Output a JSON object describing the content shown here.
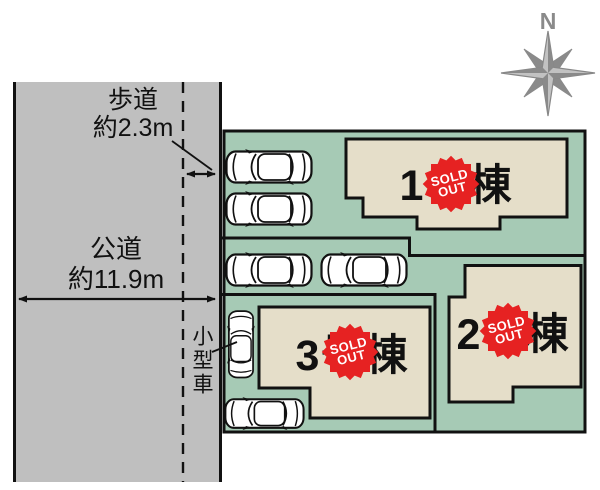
{
  "diagram": {
    "north_label": "N",
    "sidewalk_label": {
      "line1": "歩道",
      "line2": "約2.3m"
    },
    "road_label": {
      "line1": "公道",
      "line2": "約11.9m"
    },
    "small_car_label": "小型車",
    "buildings": [
      {
        "label": "1号棟",
        "status": "sold out"
      },
      {
        "label": "2号棟",
        "status": "sold out"
      },
      {
        "label": "3号棟",
        "status": "sold out"
      }
    ],
    "sold_badge": {
      "line1": "SOLD",
      "line2": "OUT"
    },
    "colors": {
      "plot_green": "#a6cab5",
      "building_beige": "#e5dec9",
      "road_gray": "#bfbfbf",
      "badge_red": "#e62222",
      "outline": "#111111",
      "compass_gray": "#8a8a8a"
    }
  }
}
